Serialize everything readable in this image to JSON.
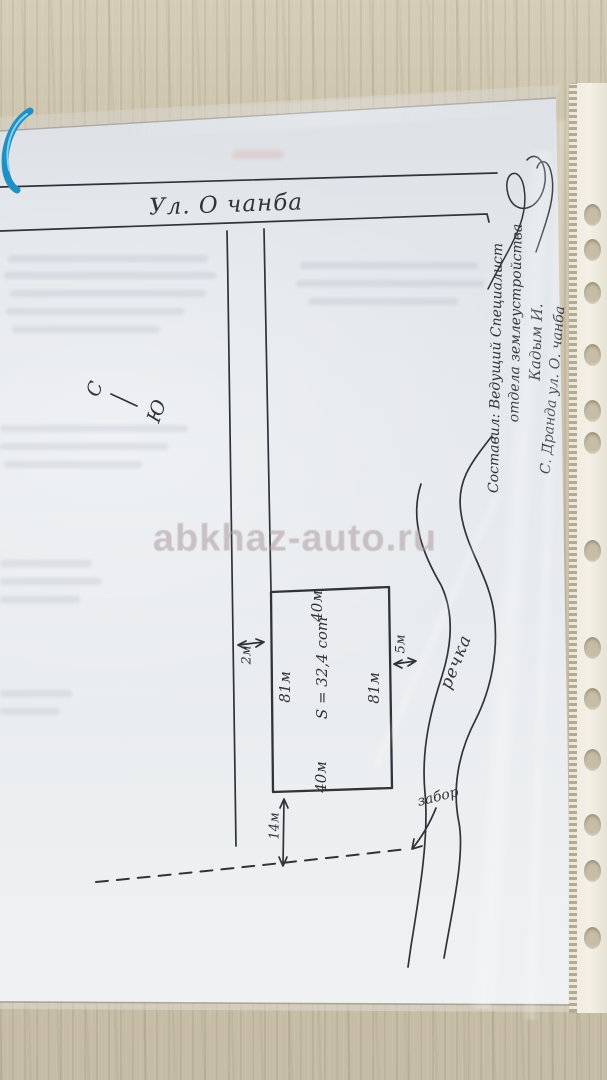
{
  "watermark": "abkhaz-auto.ru",
  "street": {
    "label": "Ул. О чанба"
  },
  "compass": {
    "north": "С",
    "south": "Ю"
  },
  "road": {
    "width_label": "2м"
  },
  "plot": {
    "top_label": "40м",
    "bottom_label": "40м",
    "left_label": "81м",
    "right_label": "81м",
    "area_label": "S = 32,4 сот"
  },
  "river": {
    "label": "речка",
    "gap_label": "5м"
  },
  "fence": {
    "label": "забор",
    "gap_label": "14м"
  },
  "author_block": {
    "line1": "Составил: Ведущий Специалист",
    "line2": "отдела землеустройства",
    "line3": "Кадым И.",
    "line4": "С. Дранда ул. О. чанба"
  },
  "colors": {
    "ink": "#30333a",
    "paper": "#e8ebee",
    "surface": "#cbc1aa",
    "watermark_tint": "#ac9b9e",
    "cable_blue": "#2196c9"
  }
}
